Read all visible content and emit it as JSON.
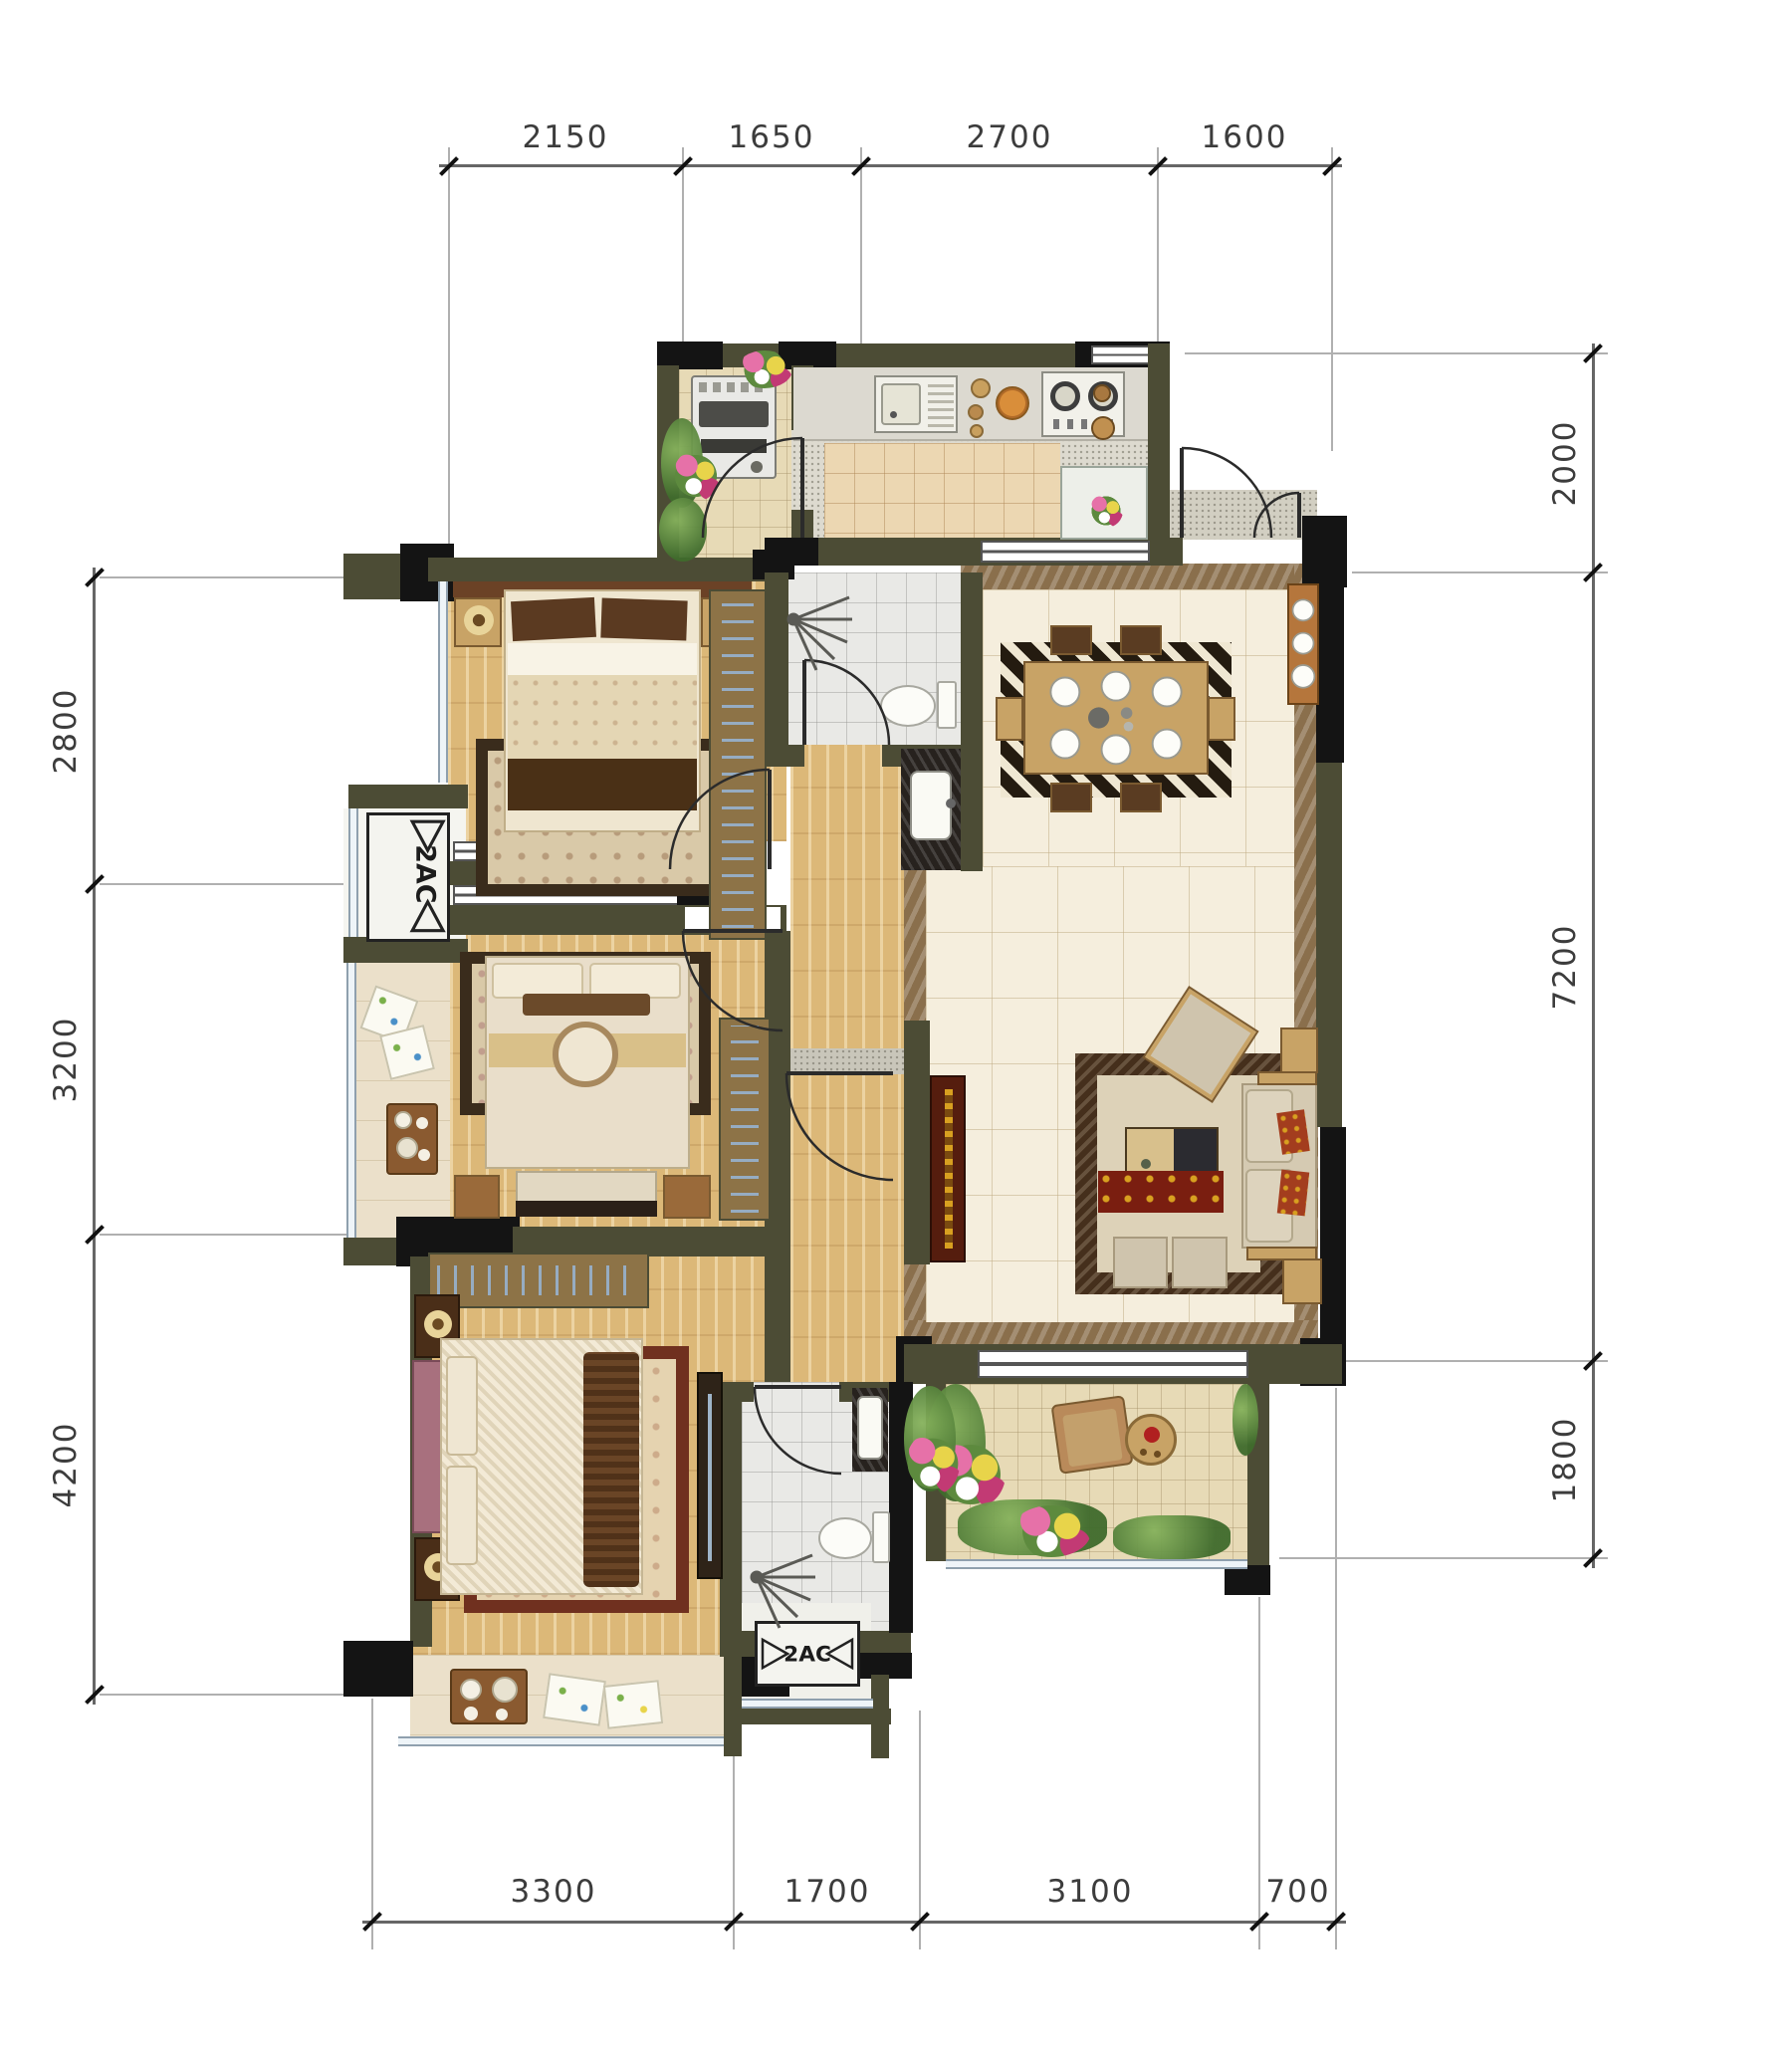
{
  "dimensions": {
    "top": [
      "2150",
      "1650",
      "2700",
      "1600"
    ],
    "left": [
      "2800",
      "3200",
      "4200"
    ],
    "right": [
      "2000",
      "7200",
      "1800"
    ],
    "bottom": [
      "3300",
      "1700",
      "3100",
      "700"
    ]
  },
  "labels": {
    "ac_left": "2AC",
    "ac_bottom": "2AC"
  },
  "colors": {
    "wall_olive": "#4c4c35",
    "wall_black": "#141414",
    "wood_floor": "#dcb878",
    "marble_floor": "#f5eedd",
    "marble_border": "#8a6f4c",
    "tile_gray": "#e9e9e6",
    "tile_beige": "#e7dab6",
    "plant_green": "#4e7a36",
    "dim_text": "#3c3c3c"
  }
}
